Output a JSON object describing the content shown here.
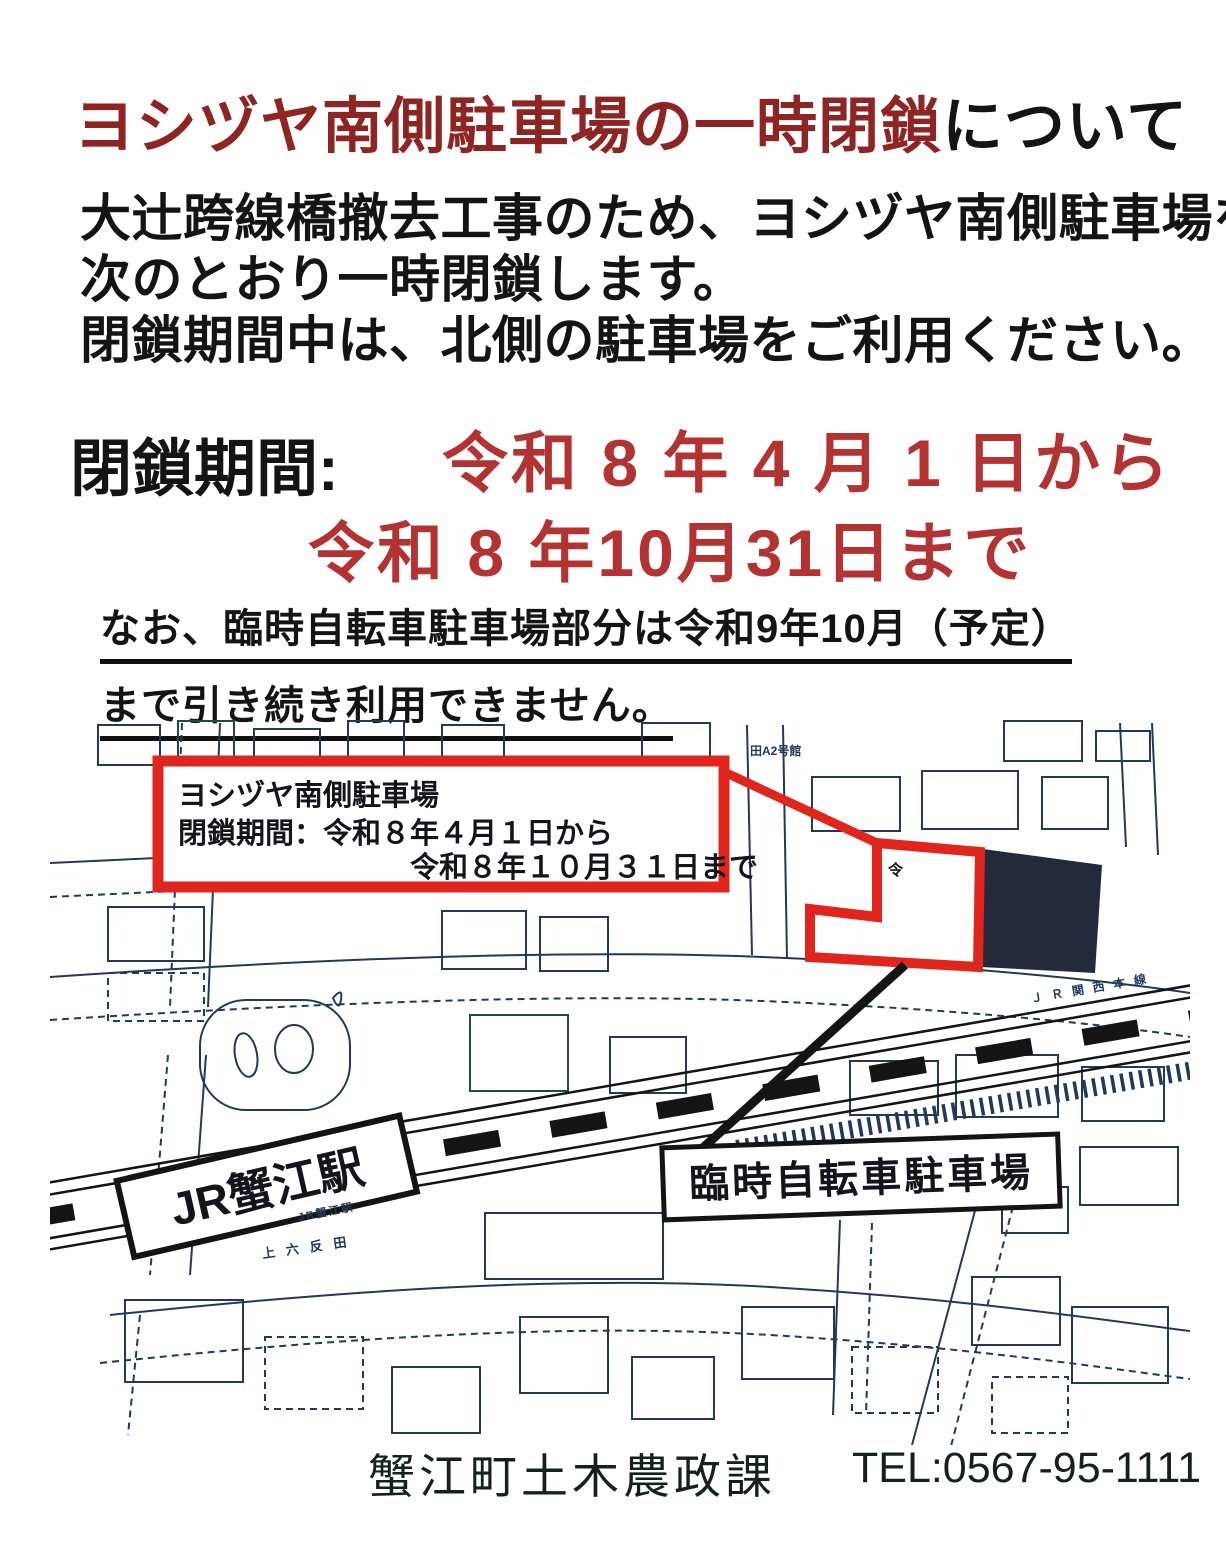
{
  "colors": {
    "title_red": "#8e2522",
    "date_red": "#b23331",
    "text_black": "#141414",
    "map_red": "#e0251c",
    "map_navy": "#242a3a",
    "map_line": "#20395c",
    "rail_black": "#141414"
  },
  "notice": {
    "title": {
      "red": "ヨシヅヤ南側駐車場の一時閉鎖",
      "black": "について"
    },
    "body": [
      "大辻跨線橋撤去工事のため、ヨシヅヤ南側駐車場を",
      "次のとおり一時閉鎖します。",
      "閉鎖期間中は、北側の駐車場をご利用ください。"
    ],
    "period": {
      "label": "閉鎖期間:",
      "from": "令和 8 年 4 月 1 日から",
      "to": "令和 8 年10月31日まで"
    },
    "note": [
      "なお、臨時自転車駐車場部分は令和9年10月（予定）",
      "まで引き続き利用できません。"
    ],
    "footer": {
      "department": "蟹江町土木農政課",
      "tel": "TEL:0567-95-1111"
    }
  },
  "map": {
    "callout": {
      "line1": "ヨシヅヤ南側駐車場",
      "line2": "閉鎖期間：令和８年４月１日から",
      "line3": "令和８年１０月３１日まで"
    },
    "labels": {
      "station": "JR蟹江駅",
      "bicycle": "臨時自転車駐車場"
    },
    "small_labels": {
      "rail_line": "ＪＲ関西本線",
      "station_small": "JR蟹江駅",
      "area_small": "上六反田",
      "building_small": "田A2号館",
      "mark": "令"
    }
  }
}
